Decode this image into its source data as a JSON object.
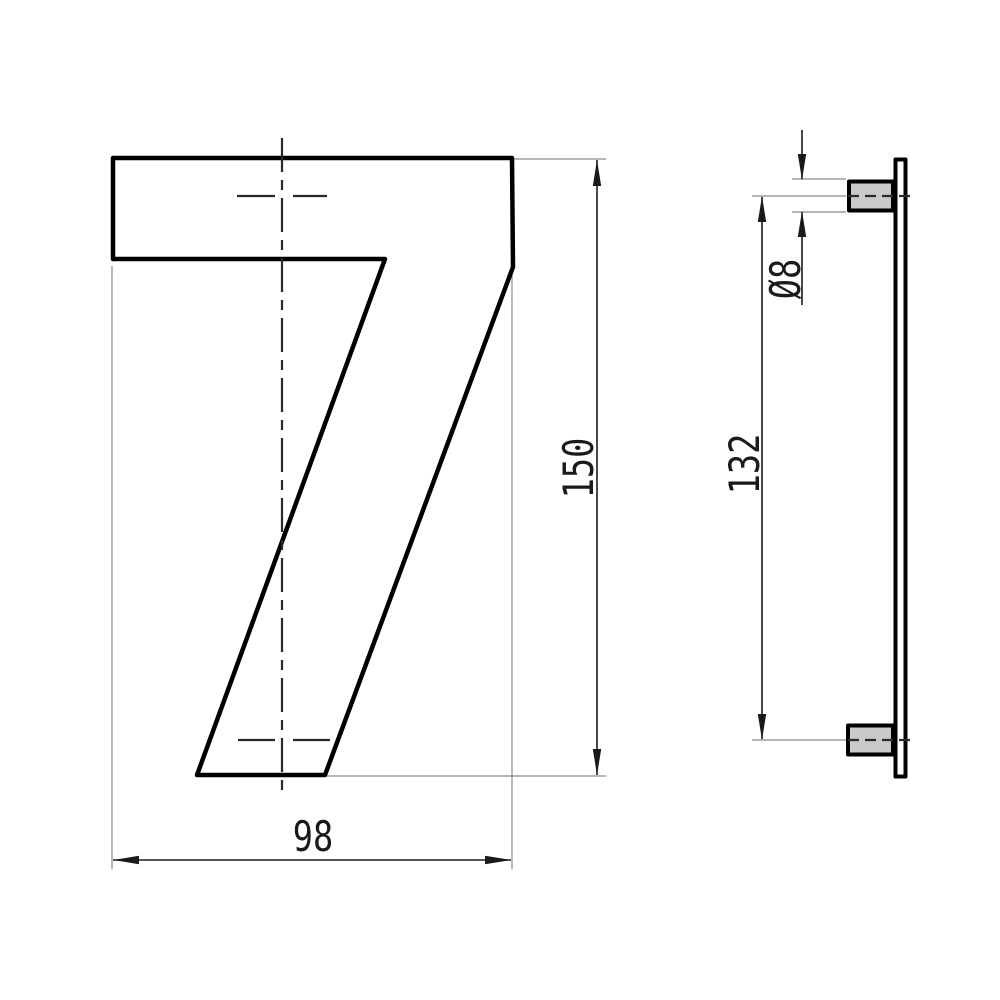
{
  "drawing": {
    "views": {
      "front": {
        "name": "front-view-numeral",
        "numeral": "7",
        "fill": "#dcdcdc"
      },
      "side": {
        "name": "side-view-plate-with-pegs",
        "plate_fill": "#ffffff",
        "peg_fill": "#c9c9c9"
      }
    },
    "dimensions": {
      "height": {
        "label": "150"
      },
      "width": {
        "label": "98"
      },
      "peg_spacing": {
        "label": "132"
      },
      "peg_diameter": {
        "label": "Ø8"
      }
    },
    "colors": {
      "outline": "#000000",
      "dimension_line": "#1a1a1a",
      "extension_line": "#8a8a8a",
      "centerline": "#2a2a2a",
      "background": "#ffffff"
    }
  }
}
